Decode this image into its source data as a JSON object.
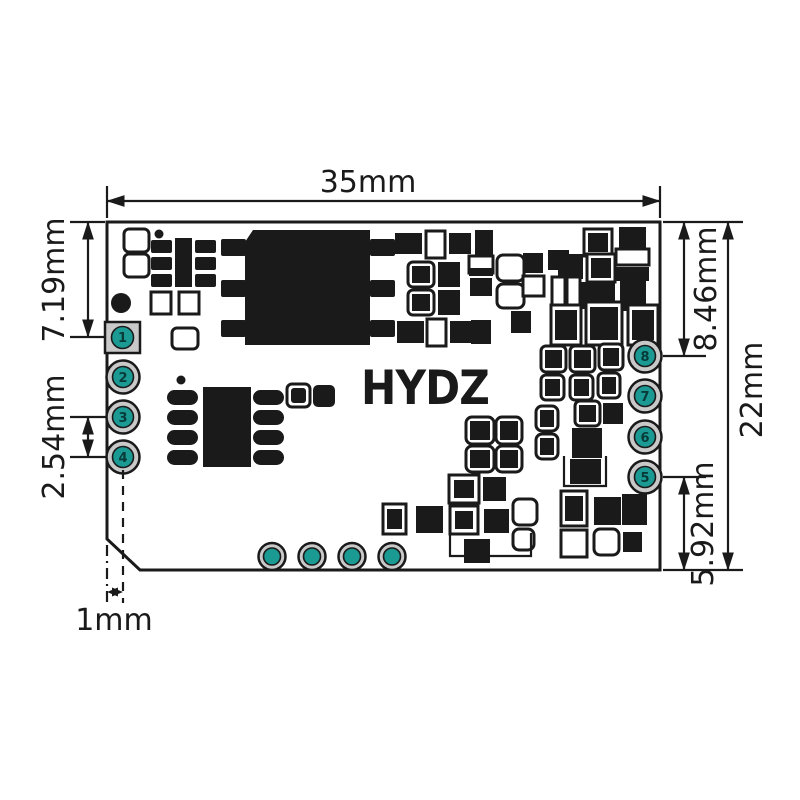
{
  "diagram": {
    "logo_text": "HYDZ",
    "dims": {
      "board_width": "35mm",
      "board_height": "22mm",
      "pin1_top_offset": "7.19mm",
      "pin_pitch": "2.54mm",
      "pin8_top_offset": "8.46mm",
      "pin5_bottom_offset": "5.92mm",
      "pad_edge_offset": "1mm"
    },
    "pads": {
      "left": [
        "1",
        "2",
        "3",
        "4"
      ],
      "right": [
        "8",
        "7",
        "6",
        "5"
      ],
      "bottom_unlabeled_count": 4
    },
    "colors": {
      "ink": "#1a1a1a",
      "pad_ring_gray": "#c9c9c9",
      "pad_core_teal": "#1b9a94",
      "board_fill": "#ffffff"
    }
  }
}
